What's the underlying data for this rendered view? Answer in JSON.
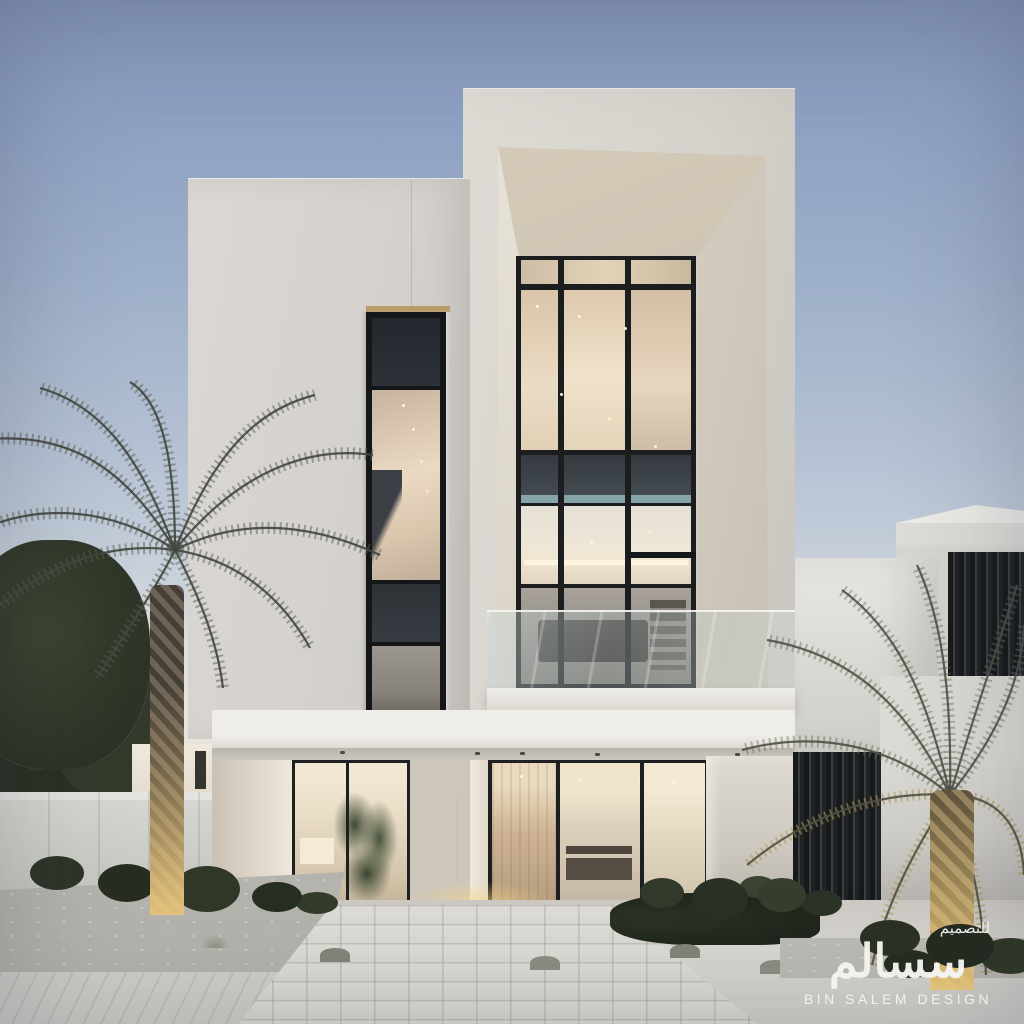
{
  "watermark": {
    "arabic_small": "للتصميم",
    "arabic_large": "سسالم",
    "brand": "BIN SALEM DESIGN"
  },
  "palette": {
    "sky_top": "#8495b9",
    "sky_horizon": "#efeeea",
    "facade_plaster": "#d7d4cf",
    "portal_ceiling": "#cfc4b2",
    "window_frame": "#1b1d1f",
    "warm_interior": "#e8d6bb",
    "spandrel_dark": "#3a4046",
    "door_wood": "#4a3829",
    "balcony_glass": "#c3ced0",
    "palm_frond": "#565b51",
    "palm_gold_light": "#b09654",
    "paving": "#d8d6d1",
    "watermark_text": "#f5f4f1"
  }
}
